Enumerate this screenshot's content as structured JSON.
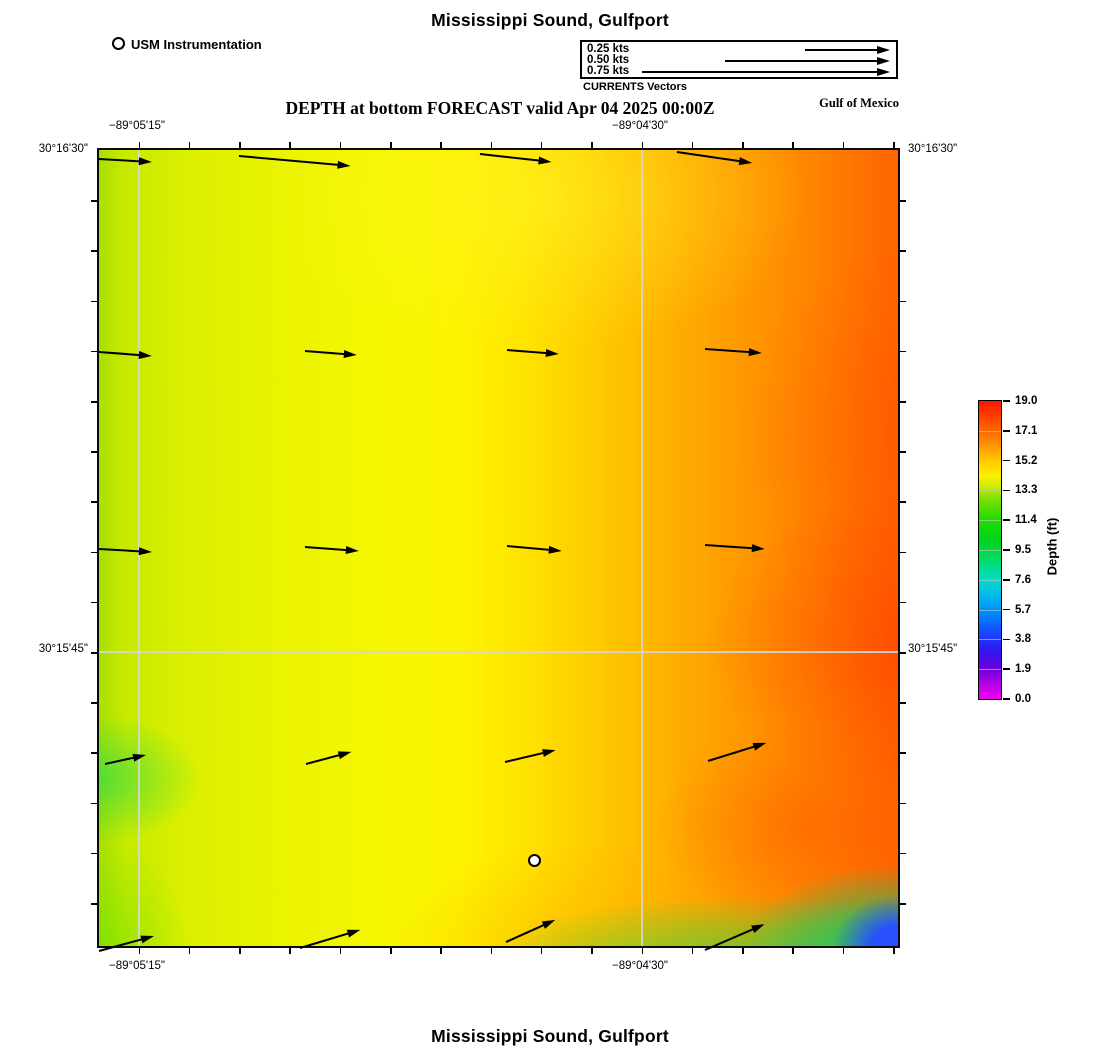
{
  "page": {
    "top_title": "Mississippi Sound, Gulfport",
    "bottom_title": "Mississippi Sound, Gulfport"
  },
  "header": {
    "station_legend_label": "USM Instrumentation",
    "forecast_title": "DEPTH at bottom FORECAST valid Apr 04 2025 00:00Z",
    "region_label": "Gulf of Mexico",
    "currents_legend": {
      "caption": "CURRENTS Vectors",
      "labels": [
        "0.25 kts",
        "0.50 kts",
        "0.75 kts"
      ]
    }
  },
  "axes": {
    "lon_labels": [
      "−89°05'15\"",
      "−89°04'30\""
    ],
    "lat_labels": [
      "30°16'30\"",
      "30°15'45\""
    ]
  },
  "colorbar": {
    "title": "Depth (ft)",
    "tick_labels": [
      "19.0",
      "17.1",
      "15.2",
      "13.3",
      "11.4",
      "9.5",
      "7.6",
      "5.7",
      "3.8",
      "1.9",
      "0.0"
    ],
    "min": 0.0,
    "max": 19.0,
    "stops": [
      {
        "pct": 0,
        "color": "#ff1400"
      },
      {
        "pct": 7,
        "color": "#ff5000"
      },
      {
        "pct": 14,
        "color": "#ff8c00"
      },
      {
        "pct": 20,
        "color": "#ffc800"
      },
      {
        "pct": 25,
        "color": "#fff000"
      },
      {
        "pct": 29,
        "color": "#c8ec00"
      },
      {
        "pct": 33,
        "color": "#78e100"
      },
      {
        "pct": 40,
        "color": "#1edc00"
      },
      {
        "pct": 47,
        "color": "#00d41e"
      },
      {
        "pct": 53,
        "color": "#00dc64"
      },
      {
        "pct": 60,
        "color": "#00dcc8"
      },
      {
        "pct": 66,
        "color": "#00b4f0"
      },
      {
        "pct": 72,
        "color": "#0082ff"
      },
      {
        "pct": 79,
        "color": "#1e3cff"
      },
      {
        "pct": 84,
        "color": "#3214f0"
      },
      {
        "pct": 90,
        "color": "#6e00dc"
      },
      {
        "pct": 95,
        "color": "#b400e6"
      },
      {
        "pct": 100,
        "color": "#f000f0"
      }
    ]
  },
  "chart_data": {
    "type": "heatmap",
    "title": "Mississippi Sound, Gulfport",
    "subtitle": "DEPTH at bottom FORECAST valid Apr 04 2025 00:00Z",
    "variable": "Depth (ft)",
    "value_range": [
      0.0,
      19.0
    ],
    "colorbar_ticks": [
      19.0,
      17.1,
      15.2,
      13.3,
      11.4,
      9.5,
      7.6,
      5.7,
      3.8,
      1.9,
      0.0
    ],
    "x_axis": {
      "label": "longitude",
      "tick_labels": [
        "−89°05'15\"",
        "−89°04'30\""
      ],
      "tick_px": [
        40,
        543
      ]
    },
    "y_axis": {
      "label": "latitude",
      "tick_labels": [
        "30°16'30\"",
        "30°15'45\""
      ],
      "tick_px": [
        0,
        502
      ]
    },
    "field_summary_depth_ft": {
      "west_edge": 13.3,
      "west": 14.2,
      "center": 15.0,
      "east_center": 16.4,
      "east_edge": 17.8,
      "southeast_corner_shoal_min": 4.5,
      "south_shore_band": 11.5
    },
    "station": {
      "name": "USM Instrumentation",
      "x_px": 339,
      "y_px": 563
    },
    "vector_scale": {
      "legend": [
        {
          "label": "0.25 kts",
          "length_px": 85
        },
        {
          "label": "0.50 kts",
          "length_px": 165
        },
        {
          "label": "0.75 kts",
          "length_px": 248
        }
      ]
    },
    "current_vectors": [
      {
        "x1": 0,
        "y1": 9,
        "x2": 53,
        "y2": 12
      },
      {
        "x1": 140,
        "y1": 6,
        "x2": 252,
        "y2": 16
      },
      {
        "x1": 381,
        "y1": 4,
        "x2": 453,
        "y2": 12
      },
      {
        "x1": 578,
        "y1": 2,
        "x2": 653,
        "y2": 13
      },
      {
        "x1": 0,
        "y1": 202,
        "x2": 53,
        "y2": 206
      },
      {
        "x1": 206,
        "y1": 201,
        "x2": 258,
        "y2": 205
      },
      {
        "x1": 408,
        "y1": 200,
        "x2": 460,
        "y2": 204
      },
      {
        "x1": 606,
        "y1": 199,
        "x2": 663,
        "y2": 203
      },
      {
        "x1": 0,
        "y1": 399,
        "x2": 53,
        "y2": 402
      },
      {
        "x1": 206,
        "y1": 397,
        "x2": 260,
        "y2": 401
      },
      {
        "x1": 408,
        "y1": 396,
        "x2": 463,
        "y2": 401
      },
      {
        "x1": 606,
        "y1": 395,
        "x2": 666,
        "y2": 399
      },
      {
        "x1": 6,
        "y1": 614,
        "x2": 47,
        "y2": 605
      },
      {
        "x1": 207,
        "y1": 614,
        "x2": 252,
        "y2": 602
      },
      {
        "x1": 406,
        "y1": 612,
        "x2": 457,
        "y2": 600
      },
      {
        "x1": 609,
        "y1": 611,
        "x2": 667,
        "y2": 593
      },
      {
        "x1": 0,
        "y1": 801,
        "x2": 55,
        "y2": 786
      },
      {
        "x1": 201,
        "y1": 798,
        "x2": 261,
        "y2": 780
      },
      {
        "x1": 407,
        "y1": 792,
        "x2": 456,
        "y2": 770
      },
      {
        "x1": 606,
        "y1": 800,
        "x2": 666,
        "y2": 774
      }
    ]
  }
}
